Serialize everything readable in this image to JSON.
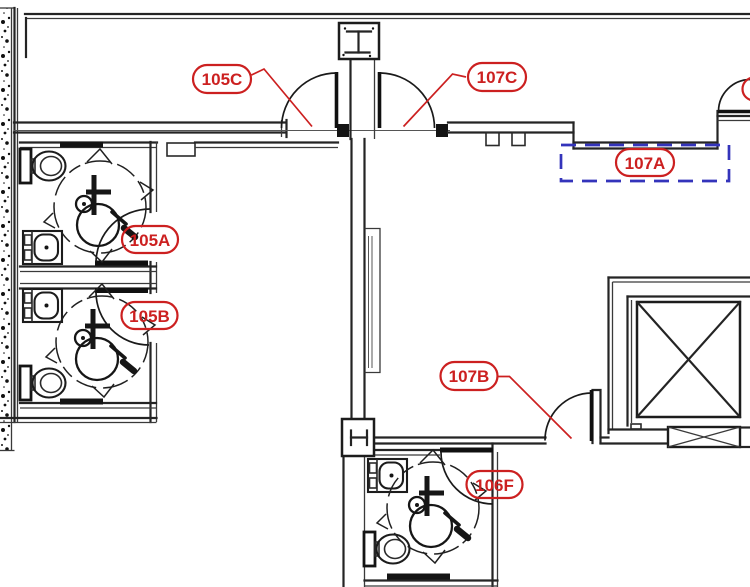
{
  "colors": {
    "tag_red": "#cc2020",
    "region_blue": "#3434bb",
    "line_black": "#1c1c1c"
  },
  "tags": {
    "t105C": {
      "label": "105C"
    },
    "t107C": {
      "label": "107C"
    },
    "t105A": {
      "label": "105A"
    },
    "t105B": {
      "label": "105B"
    },
    "t107A": {
      "label": "107A"
    },
    "t107B": {
      "label": "107B"
    },
    "t106F": {
      "label": "106F"
    }
  },
  "region_marker": {
    "id": "107A",
    "style": "blue-dashed-rectangle"
  },
  "icons": {
    "wheelchair": "wheelchair-accessible-icon",
    "turning_circle": "wheelchair-turning-circle-icon",
    "toilet": "toilet-icon",
    "sink": "sink-icon",
    "grab_bar": "grab-bar-icon",
    "door_swing": "door-swing-arc-icon",
    "elevator_cab": "elevator-cab-x-icon",
    "elevator_sill": "elevator-door-sill-x-icon",
    "steel_column": "steel-column-i-beam-icon",
    "wall_hatch": "exterior-wall-stipple-hatch"
  }
}
